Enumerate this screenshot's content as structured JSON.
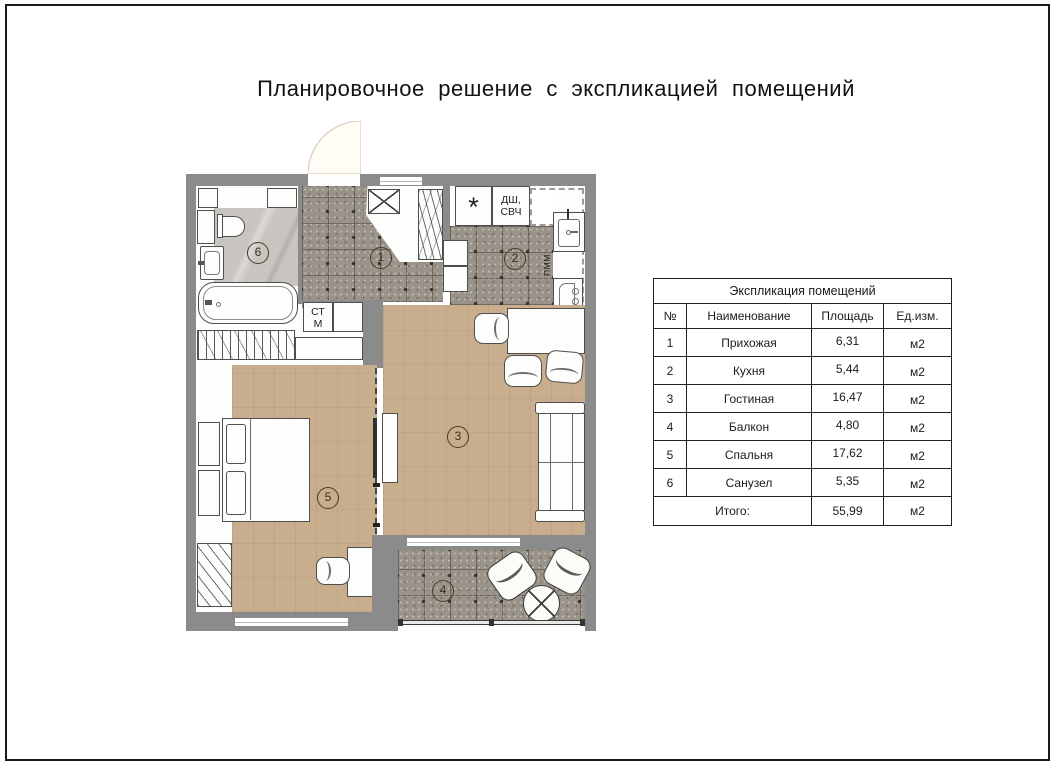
{
  "page": {
    "title": "Планировочное решение с экспликацией помещений"
  },
  "table": {
    "title": "Экспликация помещений",
    "headers": {
      "num": "№",
      "name": "Наименование",
      "area": "Площадь",
      "unit": "Ед.изм."
    },
    "rows": [
      {
        "num": "1",
        "name": "Прихожая",
        "area": "6,31",
        "unit": "м2"
      },
      {
        "num": "2",
        "name": "Кухня",
        "area": "5,44",
        "unit": "м2"
      },
      {
        "num": "3",
        "name": "Гостиная",
        "area": "16,47",
        "unit": "м2"
      },
      {
        "num": "4",
        "name": "Балкон",
        "area": "4,80",
        "unit": "м2"
      },
      {
        "num": "5",
        "name": "Спальня",
        "area": "17,62",
        "unit": "м2"
      },
      {
        "num": "6",
        "name": "Санузел",
        "area": "5,35",
        "unit": "м2"
      }
    ],
    "total": {
      "label": "Итого:",
      "area": "55,99",
      "unit": "м2"
    }
  },
  "plan": {
    "room_numbers": [
      "1",
      "2",
      "3",
      "4",
      "5",
      "6"
    ],
    "labels": {
      "stove": "*",
      "dsh": "ДШ,",
      "svch": "СВЧ",
      "pmm": "ПММ",
      "st": "СТ",
      "m": "М"
    },
    "colors": {
      "wall": "#8b8b8b",
      "wood": "#c9ae8e",
      "tile": "#9a9389",
      "marble": "#c8c5c0"
    }
  }
}
